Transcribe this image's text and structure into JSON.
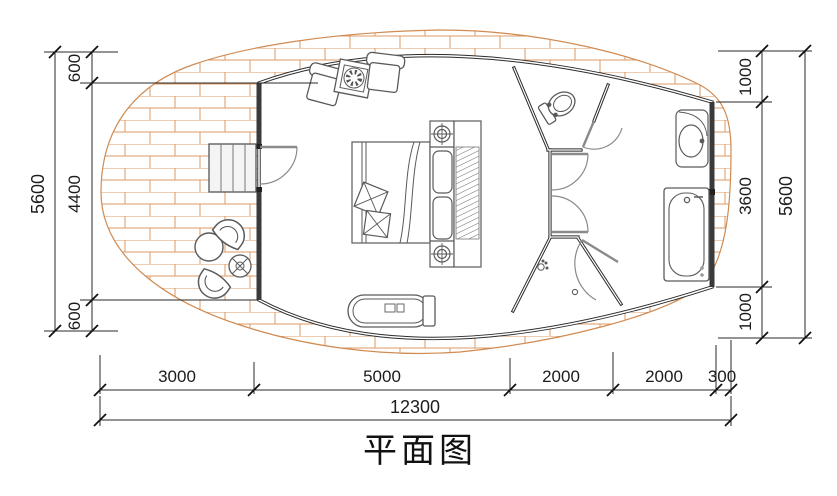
{
  "title": "平面图",
  "dims": {
    "left": {
      "total": "5600",
      "segments": [
        "600",
        "4400",
        "600"
      ]
    },
    "right": {
      "total": "5600",
      "segments": [
        "1000",
        "3600",
        "1000"
      ]
    },
    "bottom": {
      "total": "12300",
      "segments": [
        "3000",
        "5000",
        "2000",
        "2000",
        "300"
      ]
    }
  },
  "colors": {
    "wall": "#2f2f2f",
    "brick": "#de9963",
    "furniture": "#5a5a5a",
    "door": "#8a8a8a",
    "dimension": "#222222"
  }
}
